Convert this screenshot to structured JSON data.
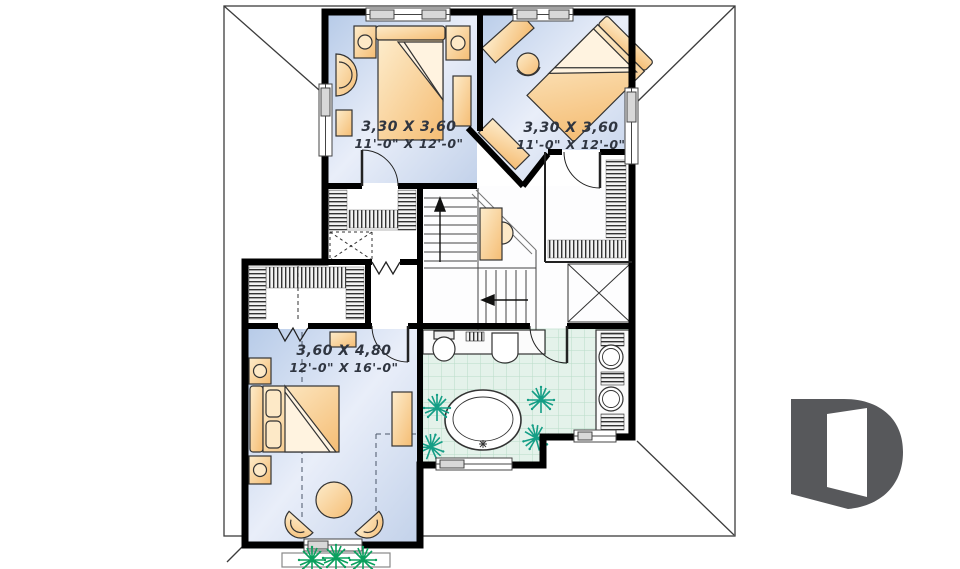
{
  "plan": {
    "title": "second-floor-plan",
    "rooms": [
      {
        "name": "bedroom-1",
        "dim_metric": "3,30 X 3,60",
        "dim_imperial": "11'-0\" X 12'-0\""
      },
      {
        "name": "bedroom-2",
        "dim_metric": "3,30 X 3,60",
        "dim_imperial": "11'-0\" X 12'-0\""
      },
      {
        "name": "master-bedroom",
        "dim_metric": "3,60 X 4,80",
        "dim_imperial": "12'-0\" X 16'-0\""
      }
    ],
    "features": [
      "stairs-up-arrow",
      "stairs-down-arrow",
      "walk-in-closet",
      "bathroom-tub",
      "double-sinks",
      "toilet",
      "flower-box"
    ]
  },
  "logo": {
    "name": "drummond-d-logo"
  },
  "colors": {
    "wall": "#000000",
    "roof_line": "#3c3c3c",
    "floor_blue_edge": "#b7cbe8",
    "floor_blue_center": "#e9eef9",
    "tile_green": "#e4f2ea",
    "tile_line": "#b9dcc8",
    "furniture_light": "#fdeccb",
    "furniture": "#f5bd74",
    "plant_bath": "#149e86",
    "plant_box": "#0ba05e",
    "label_text": "#2f3540",
    "logo_gray": "#57585b"
  }
}
